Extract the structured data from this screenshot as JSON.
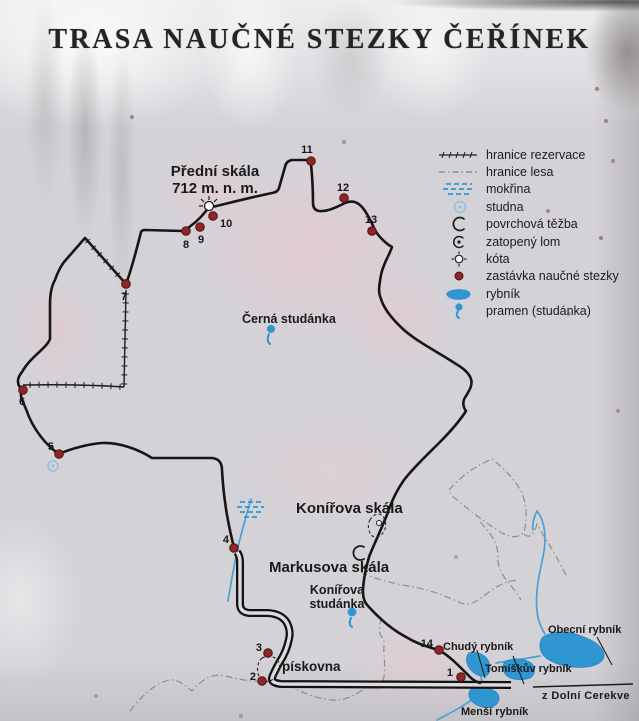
{
  "title": "TRASA NAUČNÉ STEZKY ČEŘÍNEK",
  "legend": {
    "items": [
      {
        "icon": "reservation-boundary",
        "label": "hranice rezervace"
      },
      {
        "icon": "forest-boundary",
        "label": "hranice lesa"
      },
      {
        "icon": "wetland",
        "label": "mokřina"
      },
      {
        "icon": "well",
        "label": "studna"
      },
      {
        "icon": "surface-mining",
        "label": "povrchová těžba"
      },
      {
        "icon": "flooded-quarry",
        "label": "zatopený lom"
      },
      {
        "icon": "elevation-point",
        "label": "kóta"
      },
      {
        "icon": "trail-stop",
        "label": "zastávka naučné stezky"
      },
      {
        "icon": "pond",
        "label": "rybník"
      },
      {
        "icon": "spring",
        "label": "pramen (studánka)"
      }
    ]
  },
  "map": {
    "labels": {
      "predni_skala": "Přední skála",
      "predni_skala_elev": "712 m. n. m.",
      "cerna_studanka": "Černá studánka",
      "konirova_skala": "Konířova skála",
      "markusova_skala": "Markusova skála",
      "konirova_studanka_1": "Konířova",
      "konirova_studanka_2": "studánka",
      "piskovna": "pískovna",
      "chudy_rybnik": "Chudý rybník",
      "tomiskuv_rybnik": "Tomíškův rybník",
      "obecni_rybnik": "Obecní rybník",
      "mensi_rybnik": "Menší rybník",
      "z_dolni_cerekve": "z Dolní Cerekve"
    },
    "stops": [
      "1",
      "2",
      "3",
      "4",
      "5",
      "6",
      "7",
      "8",
      "9",
      "10",
      "11",
      "12",
      "13",
      "14"
    ]
  },
  "colors": {
    "water": "#2f96d2",
    "trail": "#161616",
    "trail_stop": "#8e2626",
    "forest_boundary": "#8a9086"
  }
}
